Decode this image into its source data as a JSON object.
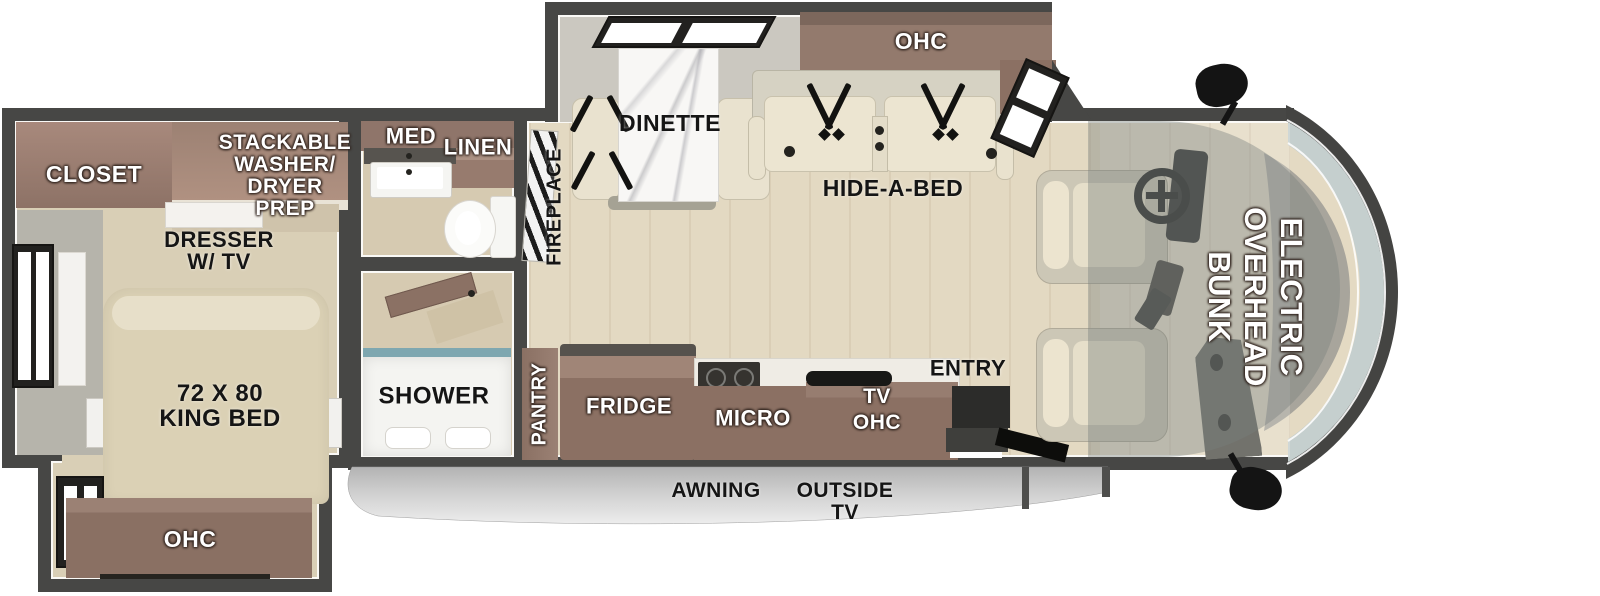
{
  "floorplan": {
    "bedroom": {
      "closet": "CLOSET",
      "washer_lines": [
        "STACKABLE",
        "WASHER/",
        "DRYER",
        "PREP"
      ],
      "dresser_lines": [
        "DRESSER",
        "W/ TV"
      ],
      "bed_lines": [
        "72 X 80",
        "KING BED"
      ],
      "ohc": "OHC"
    },
    "bath": {
      "med": "MED",
      "linen": "LINEN",
      "shower": "SHOWER"
    },
    "living": {
      "fireplace": "FIREPLACE",
      "dinette": "DINETTE",
      "ohc": "OHC",
      "hide_a_bed": "HIDE-A-BED"
    },
    "kitchen": {
      "pantry": "PANTRY",
      "fridge": "FRIDGE",
      "micro": "MICRO",
      "tv_ohc_lines": [
        "TV",
        "OHC"
      ],
      "entry": "ENTRY"
    },
    "cab": {
      "bunk_lines": [
        "ELECTRIC",
        "OVERHEAD",
        "BUNK"
      ]
    },
    "exterior": {
      "awning": "AWNING",
      "outside_tv_lines": [
        "OUTSIDE",
        "TV"
      ]
    }
  },
  "colors": {
    "wall": "#474745",
    "wood_floor": "#e3d9c2",
    "bedroom_floor": "#d9cfb6",
    "cabinet_brown": "#8b7063",
    "cabinet_light": "#a08577",
    "cream_upholstery": "#ece5d1",
    "windshield_glass": "#c5cfce",
    "awning_gray": "#cfcfcf",
    "label_white": "#ffffff",
    "label_black": "#151515"
  }
}
